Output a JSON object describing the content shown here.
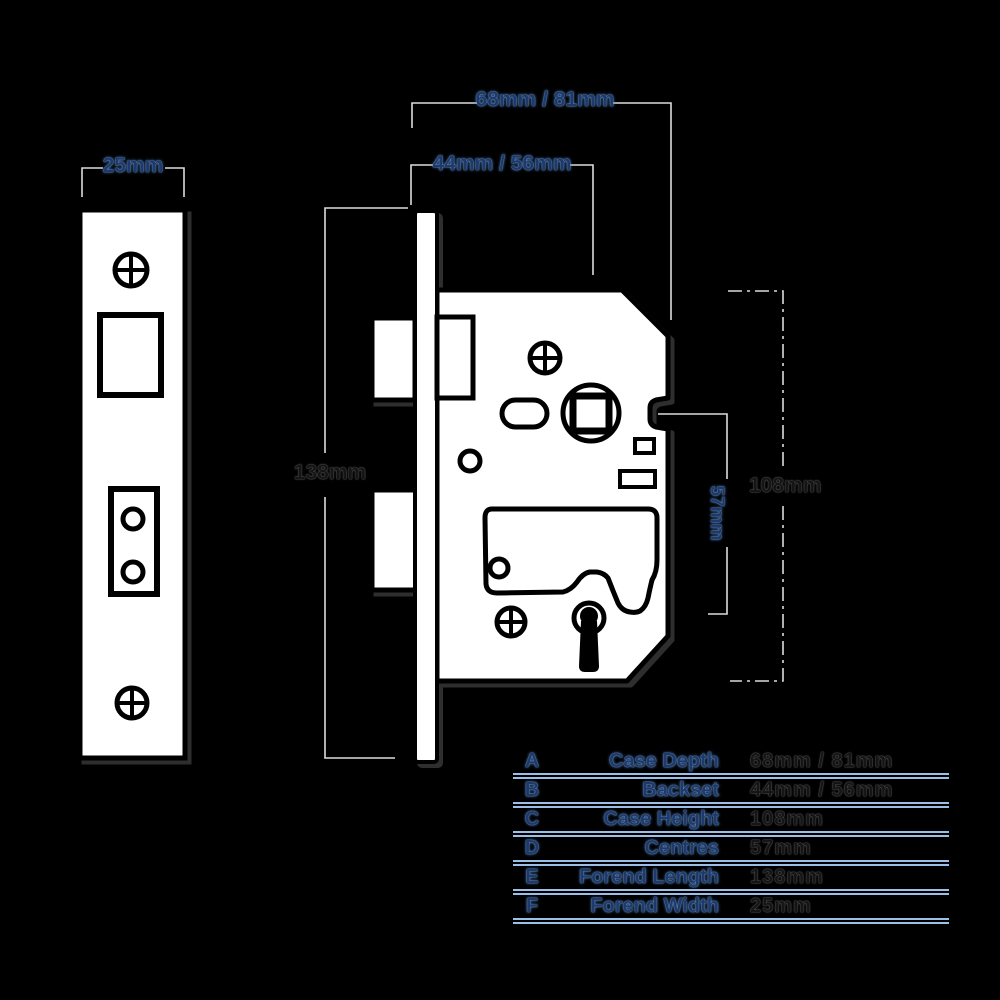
{
  "diagram": {
    "labels": {
      "forend_width": "25mm",
      "case_depth": "68mm / 81mm",
      "backset": "44mm / 56mm",
      "forend_length": "138mm",
      "case_height": "108mm",
      "centres": "57mm"
    },
    "colors": {
      "background": "#000000",
      "shape_fill": "#ffffff",
      "outline": "#000000",
      "dimension_line": "#dcdcdc",
      "label_blue": "#1c3a6e",
      "label_dark": "#151515",
      "table_rule": "#9cbfe8"
    }
  },
  "spec_table": {
    "rows": [
      {
        "letter": "A",
        "name": "Case Depth",
        "value": "68mm / 81mm"
      },
      {
        "letter": "B",
        "name": "Backset",
        "value": "44mm / 56mm"
      },
      {
        "letter": "C",
        "name": "Case Height",
        "value": "108mm"
      },
      {
        "letter": "D",
        "name": "Centres",
        "value": "57mm"
      },
      {
        "letter": "E",
        "name": "Forend Length",
        "value": "138mm"
      },
      {
        "letter": "F",
        "name": "Forend Width",
        "value": "25mm"
      }
    ]
  }
}
